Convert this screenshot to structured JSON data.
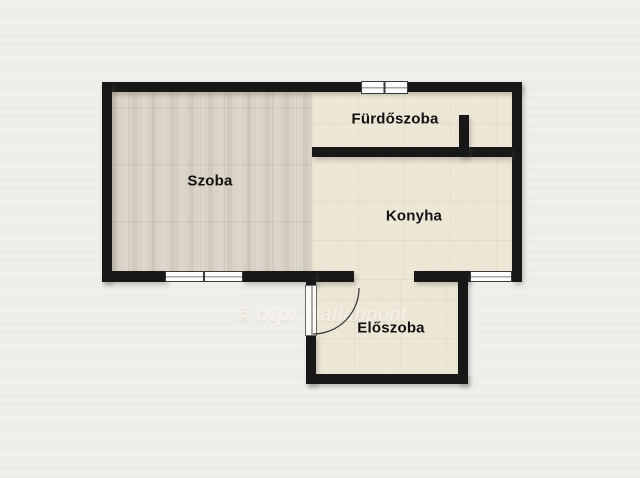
{
  "rooms": [
    {
      "label": "Szoba"
    },
    {
      "label": "Fürdőszoba"
    },
    {
      "label": "Konyha"
    },
    {
      "label": "Előszoba"
    }
  ],
  "watermark": {
    "copyright": "©",
    "brand": "otp",
    "suffix": "ingatlanpont"
  },
  "colors": {
    "background": "#f1efeb",
    "wall": "#181818",
    "wood_floor": "#d9d3c5",
    "tile_floor": "#ece6d5",
    "window_fill": "#fdfdfc",
    "label_text": "#111111"
  }
}
